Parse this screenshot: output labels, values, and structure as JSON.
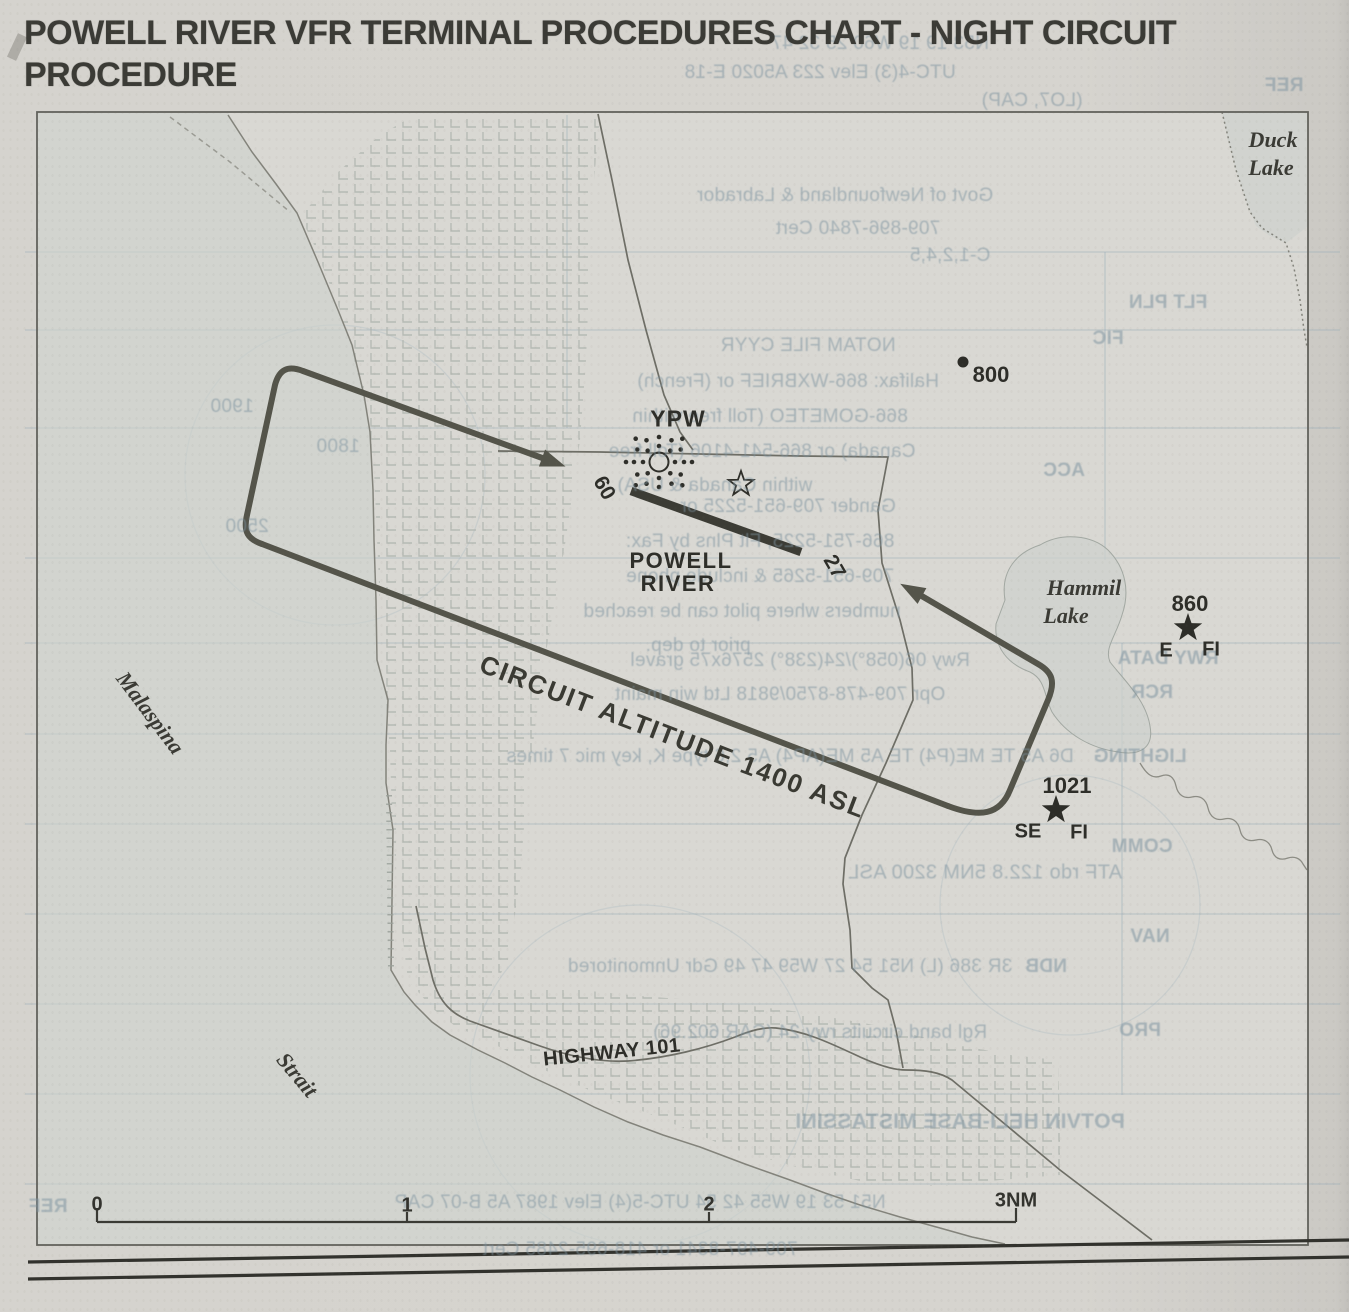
{
  "page": {
    "title_line1": "POWELL RIVER VFR TERMINAL PROCEDURES CHART - NIGHT CIRCUIT",
    "title_line2": "PROCEDURE"
  },
  "map": {
    "airport": {
      "code": "YPW",
      "name_line1": "POWELL",
      "name_line2": "RIVER"
    },
    "runway": {
      "west_number": "09",
      "east_number": "27"
    },
    "circuit_altitude_label": "CIRCUIT ALTITUDE 1400 ASL",
    "highway_label": "HIGHWAY 101",
    "geo_labels": {
      "strait_word1": "Malaspina",
      "strait_word2": "Strait",
      "duck_lake_word1": "Duck",
      "duck_lake_word2": "Lake",
      "hammil_lake_word1": "Hammil",
      "hammil_lake_word2": "Lake"
    },
    "elevations": {
      "obstacle": "800",
      "east_beacon": "860",
      "east_beacon_left": "E",
      "east_beacon_right": "FI",
      "se_beacon": "1021",
      "se_beacon_left": "SE",
      "se_beacon_right": "FI"
    },
    "scale_bar": {
      "tick0": "0",
      "tick1": "1",
      "tick2": "2",
      "tick3": "3NM"
    }
  },
  "colors": {
    "paper": "#d6d4cf",
    "map_paper": "#d9d8d3",
    "ink": "#2e2e29",
    "circuit_line": "#54544a",
    "water": "#cdd2cd",
    "hatch": "#b0b5af",
    "road": "#6e6e66",
    "bleed_text": "#7d94a0"
  },
  "bleed_through_text": [
    {
      "t": "N53 19 19 W60 25 32  47",
      "x": 880,
      "y": 44
    },
    {
      "t": "UTC-4(3)  Elev 223   A5020  E-18",
      "x": 820,
      "y": 73
    },
    {
      "t": "(LO7, CAP)",
      "x": 1032,
      "y": 101
    },
    {
      "t": "REF",
      "x": 1284,
      "y": 86,
      "w": 700
    },
    {
      "t": "Govt of Newfoundland & Labrador",
      "x": 845,
      "y": 196
    },
    {
      "t": "709-896-7840   Cert",
      "x": 858,
      "y": 229
    },
    {
      "t": "C-1,2,4,5",
      "x": 950,
      "y": 256
    },
    {
      "t": "FLT PLN",
      "x": 1168,
      "y": 303,
      "w": 700
    },
    {
      "t": "NOTAM FILE CYYR",
      "x": 808,
      "y": 346
    },
    {
      "t": "FIC",
      "x": 1108,
      "y": 339,
      "w": 700
    },
    {
      "t": "Halifax: 866-WXBRIEF or (French)",
      "x": 788,
      "y": 382
    },
    {
      "t": "866-GOMETEO (Toll free within",
      "x": 770,
      "y": 417
    },
    {
      "t": "Canada) or 866-541-4106 (Toll free",
      "x": 762,
      "y": 452
    },
    {
      "t": "within Canada & USA).",
      "x": 712,
      "y": 486
    },
    {
      "t": "ACC",
      "x": 1064,
      "y": 471,
      "w": 700
    },
    {
      "t": "Gander 709-651-5225 or",
      "x": 788,
      "y": 507
    },
    {
      "t": "866-751-5225, Flt Plns by Fax:",
      "x": 760,
      "y": 542
    },
    {
      "t": "709-651-5265 & include phone",
      "x": 760,
      "y": 577
    },
    {
      "t": "numbers where pilot can be reached",
      "x": 742,
      "y": 612
    },
    {
      "t": "prior to dep.",
      "x": 698,
      "y": 646
    },
    {
      "t": "RWY DATA",
      "x": 1168,
      "y": 659,
      "w": 700
    },
    {
      "t": "Rwy 06(058°)/24(238°) 2576x75 gravel",
      "x": 800,
      "y": 661
    },
    {
      "t": "RCR",
      "x": 1152,
      "y": 693,
      "w": 700
    },
    {
      "t": "Opr 709-478-8750/9818  Ltd win maint",
      "x": 780,
      "y": 695
    },
    {
      "t": "LIGHTING",
      "x": 1140,
      "y": 757,
      "w": 700
    },
    {
      "t": "D6 A5 TE  ME(P4)  TE A5  ME(AP4)  A5  2,6 type K, key mic 7 times",
      "x": 790,
      "y": 757
    },
    {
      "t": "COMM",
      "x": 1142,
      "y": 847,
      "w": 700
    },
    {
      "t": "ATF   rdo  122.8    5NM  3200 ASL",
      "x": 985,
      "y": 873,
      "s": 20
    },
    {
      "t": "NAV",
      "x": 1150,
      "y": 937,
      "w": 700
    },
    {
      "t": "NDB",
      "x": 1046,
      "y": 967,
      "w": 700
    },
    {
      "t": "3R 386  (L)  N51 54 27 W59 47 49    Gdr    Unmonitored",
      "x": 790,
      "y": 967
    },
    {
      "t": "PRO",
      "x": 1140,
      "y": 1031,
      "w": 700
    },
    {
      "t": "Rgl band circuits rwy 24 (CAR 602.96)",
      "x": 820,
      "y": 1033
    },
    {
      "t": "POTVIN HELI-BASE                 MISTASSINI",
      "x": 960,
      "y": 1122,
      "s": 21,
      "w": 700
    },
    {
      "t": "N51 53 19 W55 42 54    UTC-5(4)    Elev 1987    A5    B-07    CAP",
      "x": 640,
      "y": 1203
    },
    {
      "t": "REF",
      "x": 48,
      "y": 1207,
      "w": 700
    },
    {
      "t": "709-497-8341  or  418-695-2485    Cert",
      "x": 640,
      "y": 1250
    },
    {
      "t": "1900",
      "x": 232,
      "y": 407
    },
    {
      "t": "1800",
      "x": 338,
      "y": 447
    },
    {
      "t": "2500",
      "x": 247,
      "y": 527
    }
  ]
}
